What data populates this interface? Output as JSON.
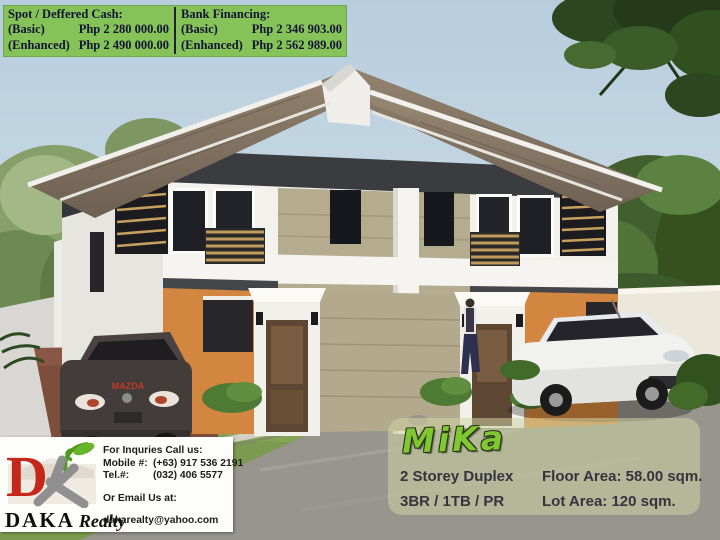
{
  "banner": {
    "spot": {
      "title": "Spot / Deffered Cash:",
      "rows": [
        {
          "label": "(Basic)",
          "value": "Php 2 280 000.00"
        },
        {
          "label": "(Enhanced)",
          "value": "Php 2 490 000.00"
        }
      ]
    },
    "bank": {
      "title": "Bank Financing:",
      "rows": [
        {
          "label": "(Basic)",
          "value": "Php 2 346 903.00"
        },
        {
          "label": "(Enhanced)",
          "value": "Php 2 562 989.00"
        }
      ]
    }
  },
  "brand": {
    "name": "DAKA",
    "suffix": "Realty",
    "logo_letter": "D"
  },
  "contact": {
    "call_heading": "For Inquries Call us:",
    "mobile_label": "Mobile #:",
    "mobile_value": "(+63) 917 536 2191",
    "tel_label": "Tel.#:",
    "tel_value": "(032) 406 5577",
    "email_heading": "Or Email Us at:",
    "email": "dakarealty@yahoo.com"
  },
  "property": {
    "name": "MiKa",
    "type": "2 Storey Duplex",
    "configuration": "3BR / 1TB / PR",
    "floor_area_label": "Floor Area:",
    "floor_area_value": "58.00 sqm.",
    "lot_area_label": "Lot Area:",
    "lot_area_value": "120 sqm."
  },
  "colors": {
    "banner_green": "#85c257",
    "banner_text_navy": "#131335",
    "logo_red": "#c5271b",
    "leaf_green": "#5a9e1e",
    "mika_green": "#7fc832",
    "wall_orange": "#d2863f",
    "roof_brown": "#7d6f5f",
    "sky_blue": "#c6d6e2"
  }
}
